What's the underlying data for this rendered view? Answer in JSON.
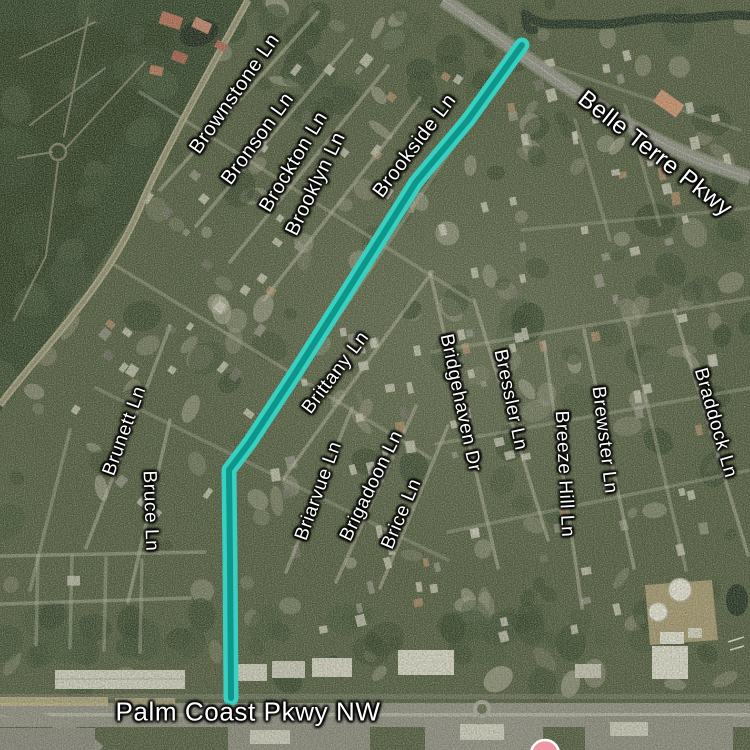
{
  "map": {
    "title": "Satellite map with highlighted route to Palm Coast Pkwy NW",
    "route": {
      "points": "522,45 468,120 416,182 348,290 294,375 250,442 229,470 230,560 231,698",
      "outer_color": "#38d1c1",
      "inner_color": "#0f968b"
    },
    "marker": {
      "fill": "#ee98a4",
      "ring": "#ffffff",
      "inner": "#d6677d"
    },
    "labels": [
      {
        "text": "Brownstone Ln",
        "kind": "street"
      },
      {
        "text": "Bronson Ln",
        "kind": "street"
      },
      {
        "text": "Brockton Ln",
        "kind": "street"
      },
      {
        "text": "Brooklyn Ln",
        "kind": "street"
      },
      {
        "text": "Brookside Ln",
        "kind": "street"
      },
      {
        "text": "Belle Terre Pkwy",
        "kind": "parkway"
      },
      {
        "text": "Brittany Ln",
        "kind": "street"
      },
      {
        "text": "Briarvue Ln",
        "kind": "street"
      },
      {
        "text": "Brigadoon Ln",
        "kind": "street"
      },
      {
        "text": "Brice Ln",
        "kind": "street"
      },
      {
        "text": "Bridgehaven Dr",
        "kind": "street"
      },
      {
        "text": "Bressler Ln",
        "kind": "street"
      },
      {
        "text": "Breeze Hill Ln",
        "kind": "street"
      },
      {
        "text": "Brewster Ln",
        "kind": "street"
      },
      {
        "text": "Braddock Ln",
        "kind": "street"
      },
      {
        "text": "Brunett Ln",
        "kind": "street"
      },
      {
        "text": "Bruce Ln",
        "kind": "street"
      },
      {
        "text": "Palm Coast Pkwy NW",
        "kind": "parkway"
      }
    ]
  }
}
